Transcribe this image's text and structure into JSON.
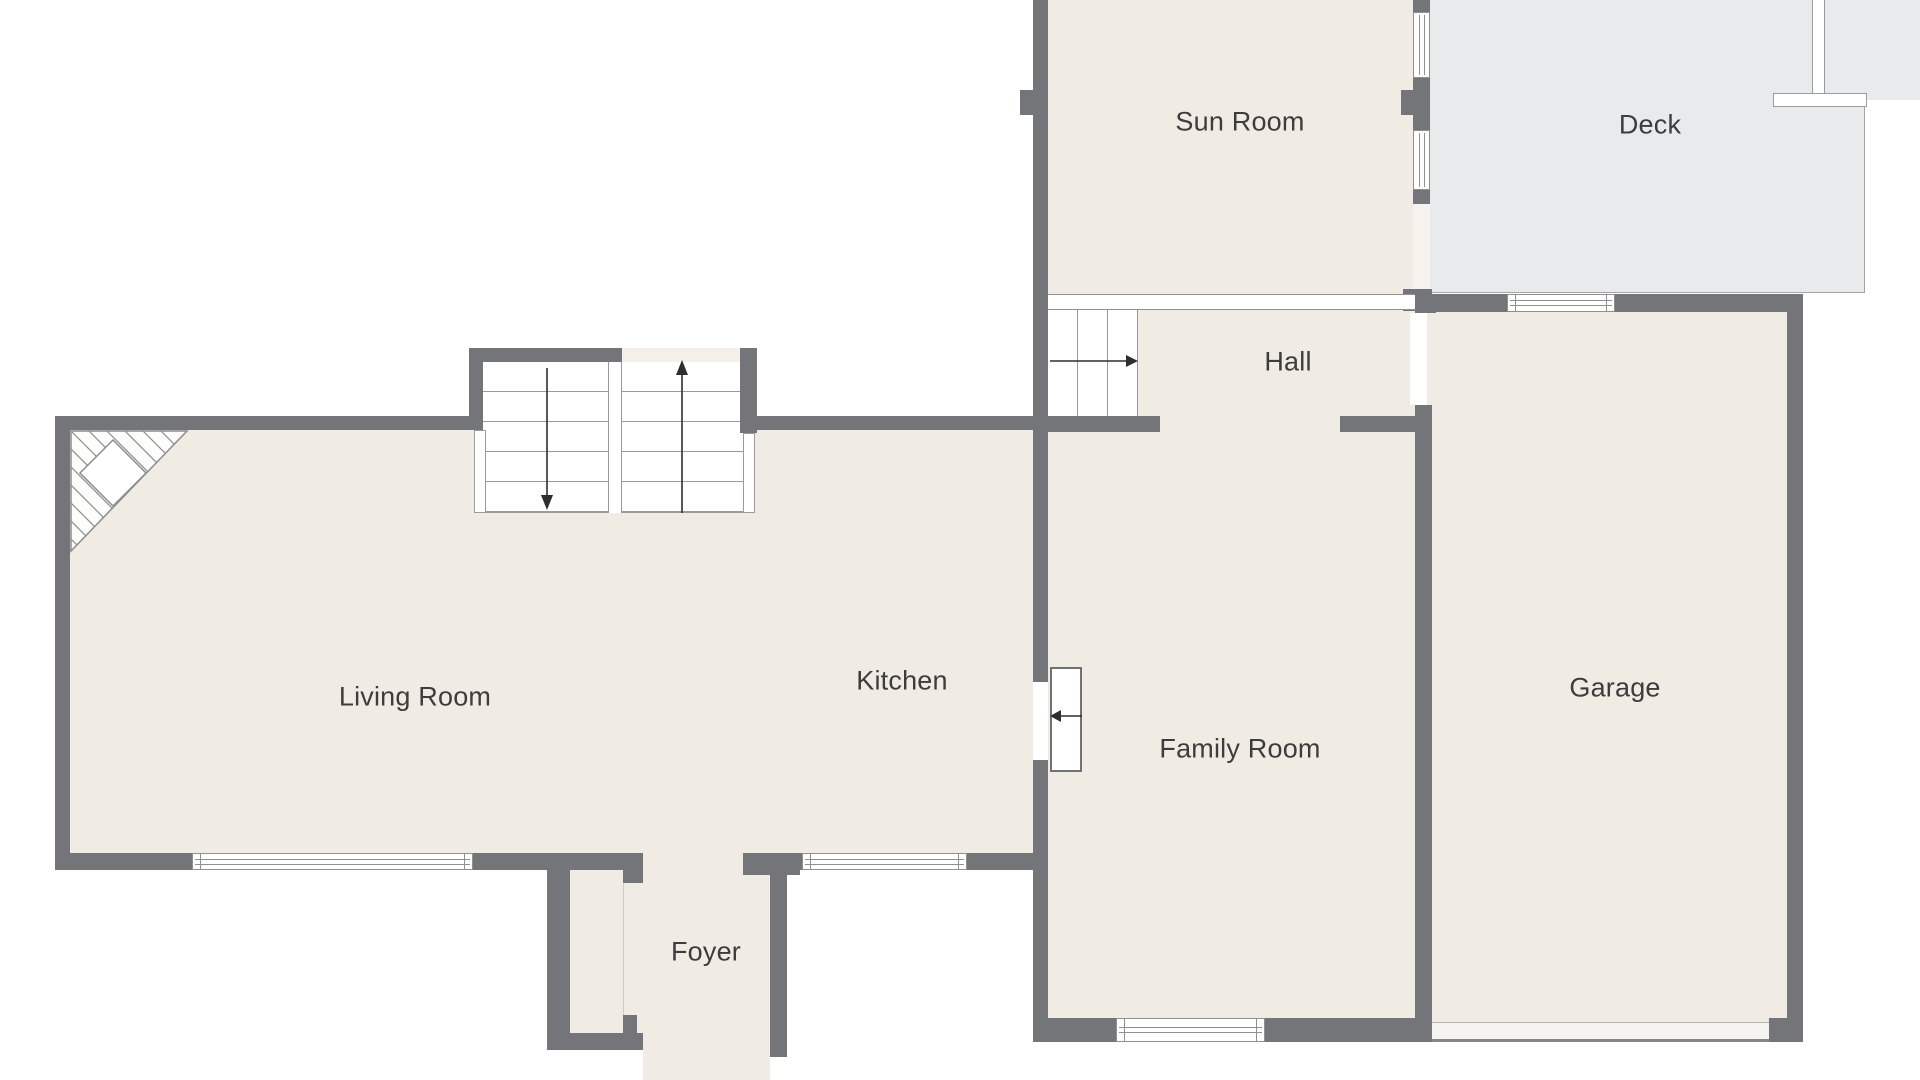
{
  "document": {
    "type": "residential-floor-plan",
    "floor": "main"
  },
  "rooms": {
    "sun_room": {
      "label": "Sun Room"
    },
    "deck": {
      "label": "Deck"
    },
    "hall": {
      "label": "Hall"
    },
    "living_room": {
      "label": "Living Room"
    },
    "kitchen": {
      "label": "Kitchen"
    },
    "family_room": {
      "label": "Family Room"
    },
    "garage": {
      "label": "Garage"
    },
    "foyer": {
      "label": "Foyer"
    }
  },
  "symbols": {
    "main_stairs": {
      "left_flight_direction": "down",
      "right_flight_direction": "up"
    },
    "hall_stairs": {
      "direction": "right"
    },
    "kitchen_door": {
      "swing_direction": "left"
    },
    "fireplace": {
      "location": "living-room-northwest-corner"
    }
  },
  "colors": {
    "bg": "#ffffff",
    "floor": "#f0ebe3",
    "deck": "#e9eaec",
    "wall": "#747578",
    "line": "#8f9092",
    "stair": "#9a9b9d",
    "text": "#3d3d3d",
    "arrow": "#2e2e2e"
  }
}
